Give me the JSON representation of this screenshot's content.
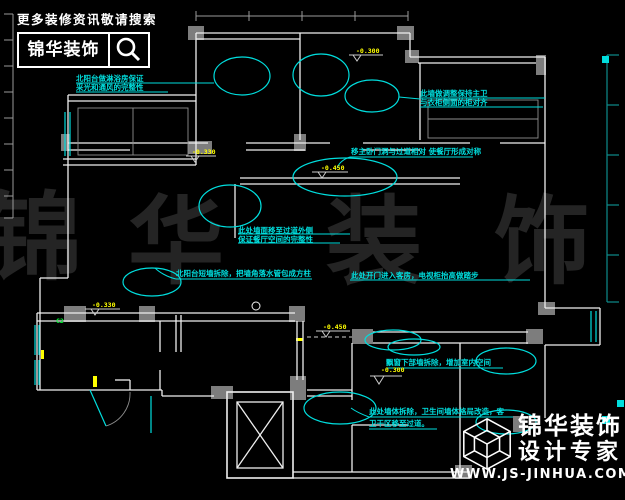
{
  "header": {
    "tagline": "更多装修资讯敬请搜索",
    "brand": "锦华装饰",
    "search_icon": "magnifier-icon"
  },
  "watermark": {
    "chars": [
      "锦",
      "华",
      "装",
      "饰"
    ]
  },
  "annotations": [
    {
      "lines": [
        "北阳台做淋浴房保证",
        "采光和通风的完整性"
      ]
    },
    {
      "lines": [
        "此墙做调整保持主卫",
        "与衣柜侧面的柜对齐"
      ]
    },
    {
      "lines": [
        "移主卧门洞与过道相对 使餐厅形成对称"
      ]
    },
    {
      "lines": [
        "此处墙面移至过道外侧",
        "保证餐厅空间的完整性"
      ]
    },
    {
      "lines": [
        "北阳台短墙拆除，把墙角落水管包成方柱"
      ]
    },
    {
      "lines": [
        "此处开门进入客房，电视柜抬高做踏步"
      ]
    },
    {
      "lines": [
        "飘窗下部墙拆除，增加室内空间"
      ]
    },
    {
      "lines": [
        "此处墙体拆除，卫生间墙体格局改造，客",
        "卫干区移至过道。"
      ]
    }
  ],
  "levels": [
    {
      "value": "-0.300"
    },
    {
      "value": "-0.330"
    },
    {
      "value": "-0.450"
    },
    {
      "value": "-0.330"
    },
    {
      "value": "-0.450"
    },
    {
      "value": "-0.300"
    }
  ],
  "tags": {
    "window": "C2"
  },
  "footer": {
    "brand_line1": "锦华装饰",
    "brand_line2": "设计专家",
    "url": "WWW.JS-JINHUA.COM",
    "logo_icon": "wireframe-cube-icon"
  },
  "colors": {
    "background": "#000000",
    "wall": "#efefef",
    "block": "#7d7d7d",
    "annotation": "#00dede",
    "level": "#ffff00",
    "watermark": "#242424",
    "accent_green": "#00ff36",
    "ruler_teal": "#0e8c8c"
  }
}
